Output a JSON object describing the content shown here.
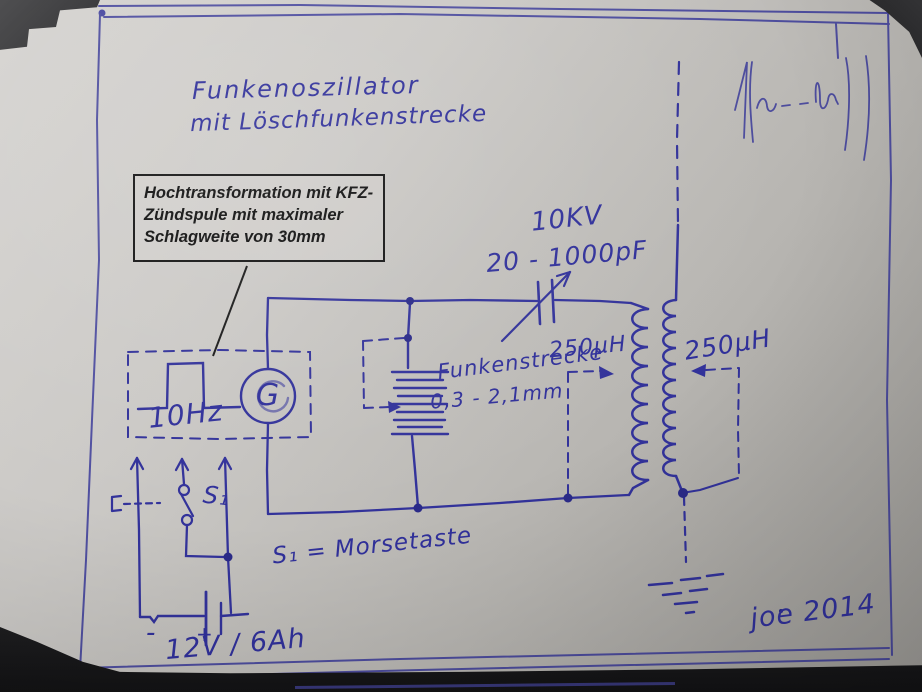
{
  "colors": {
    "ink_blue": "#32329a",
    "annotation_black": "#141414",
    "paper_light": "#d6d4d1",
    "paper_dark": "#9c9a96",
    "background_dark": "#232325"
  },
  "title": {
    "line1": "Funkenoszillator",
    "line2": "mit Löschfunkenstrecke"
  },
  "callout": {
    "line1": "Hochtransformation mit KFZ-",
    "line2": "Zündspule mit maximaler",
    "line3": "Schlagweite von 30mm"
  },
  "components": {
    "capacitor": {
      "voltage": "10KV",
      "range": "20 - 1000pF"
    },
    "spark_gap": {
      "name": "Funkenstrecke",
      "gap_range": "0,3 - 2,1mm"
    },
    "coil_primary": {
      "value": "250µH"
    },
    "coil_secondary": {
      "value": "250µH"
    },
    "generator": {
      "frequency": "10Hz",
      "symbol_letter": "G"
    },
    "switch": {
      "label": "S₁",
      "note": "S₁ = Morsetaste"
    },
    "battery": {
      "label": "12V / 6Ah",
      "minus": "-",
      "plus": "+"
    }
  },
  "signature": "joe 2014"
}
